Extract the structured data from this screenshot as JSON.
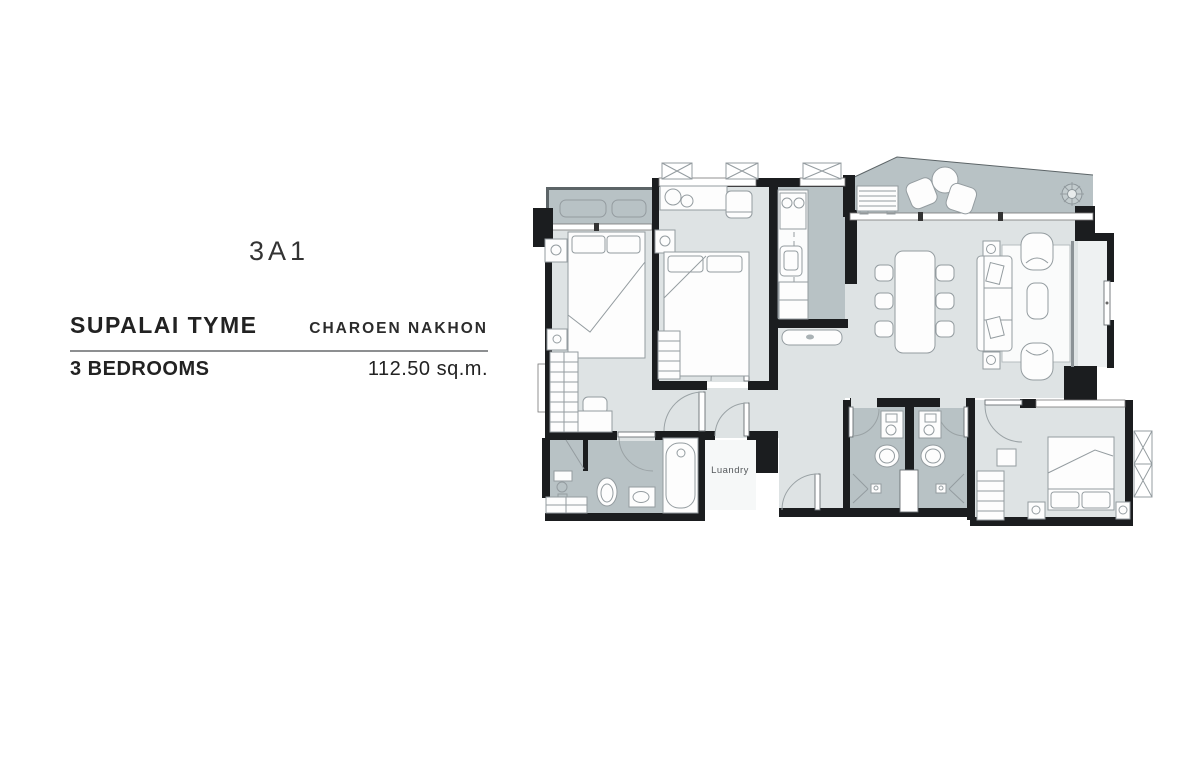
{
  "title_block": {
    "unit_code": "3A1",
    "project_name": "SUPALAI TYME",
    "project_location": "CHAROEN NAKHON",
    "unit_type": "3 BEDROOMS",
    "unit_area": "112.50 sq.m."
  },
  "floor_plan": {
    "labels": {
      "laundry": "Luandry"
    }
  },
  "colors": {
    "wall": "#1b1d1f",
    "floor-light": "#dee3e4",
    "floor-dark": "#b8c2c5",
    "floor-white": "#f6f8f8",
    "furn-stroke": "#949ca0",
    "thin": "#5c6467",
    "text": "#333333",
    "divider": "#8d8f91"
  }
}
